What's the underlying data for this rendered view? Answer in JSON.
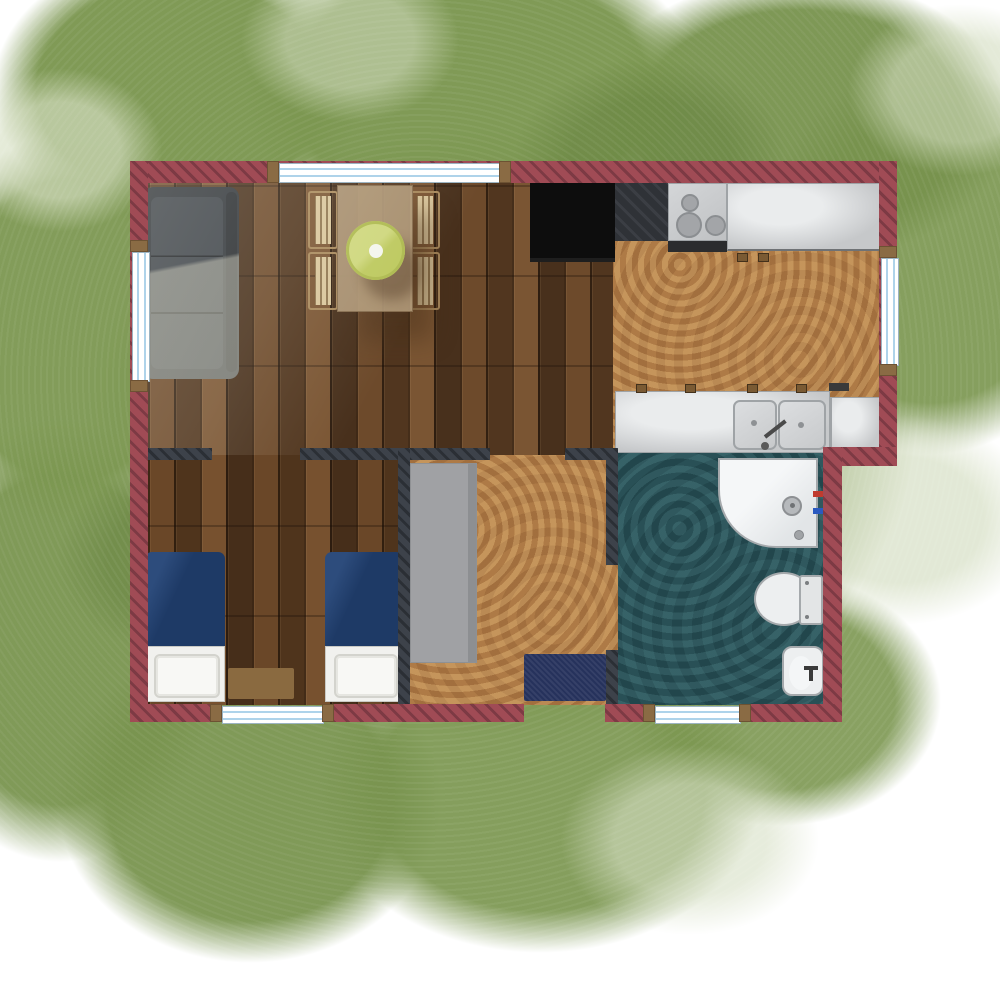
{
  "scene": {
    "type": "floor-plan",
    "description": "Top-down architectural floor plan of a small cabin set on a green watercolor foliage backdrop",
    "colors": {
      "exterior_wall": "#a04b55",
      "exterior_wall_stripe": "#7d3a44",
      "interior_wall": "#3d424a",
      "interior_wall_stripe": "#2b2f35",
      "window_glass": "#aed3ea",
      "window_frame": "#9cb4c2",
      "wall_cap": "#8a6b44",
      "wood_base": "#5f3f26",
      "wood_mid": "#6d4a2b",
      "wood_dark": "#51361f",
      "wood_light": "#7a5533",
      "cork_base": "#b17d46",
      "teal_base": "#2c5157",
      "counter_gray": "#c6c8ca",
      "counter_border": "#9fa3a6",
      "appliance_black": "#0d0d0d",
      "dark_worktop": "#2f3237",
      "sofa_dark": "#2f343a",
      "sofa_cushion": "#3b4148",
      "table_tan": "#b09877",
      "chair_tan": "#d9c69c",
      "chair_border": "#a8895c",
      "parasol_green": "#bdc95f",
      "bed_blue": "#1e3a66",
      "linen_white": "#f1f1ee",
      "rug_brown": "#8a6a40",
      "doormat_navy": "#26325c",
      "wardrobe_gray": "#9c9da0",
      "fixture_white": "#edeff0",
      "fixture_border": "#a5a9ac",
      "hot_red": "#c03b2e",
      "cold_blue": "#2a5ac0",
      "grass_green": "#7c9751",
      "grass_light": "#cdd8b8",
      "grass_dark": "#64803e"
    },
    "rooms": [
      {
        "id": "living-dining",
        "floor": "wood planks",
        "items": [
          "sofa",
          "dining table",
          "four chairs",
          "green parasol centerpiece"
        ]
      },
      {
        "id": "kitchen",
        "floor": "cork",
        "items": [
          "black appliance",
          "dark worktop",
          "stove with three burners",
          "long counter",
          "sink counter with double sink and faucet",
          "corner counter",
          "cabinet handles"
        ]
      },
      {
        "id": "bedroom",
        "floor": "wood planks",
        "items": [
          "single bed left",
          "single bed right",
          "bedside rug"
        ]
      },
      {
        "id": "hallway",
        "floor": "cork",
        "items": [
          "wardrobe",
          "navy doormat"
        ]
      },
      {
        "id": "bathroom",
        "floor": "teal vinyl",
        "items": [
          "shower tray",
          "toilet",
          "bidet",
          "hot water mark",
          "cold water mark"
        ]
      }
    ],
    "windows": [
      "top wall",
      "left wall",
      "right wall",
      "bedroom bottom wall",
      "bathroom bottom wall"
    ],
    "door_openings": [
      "living room to bedroom",
      "living room to hallway",
      "hallway to bathroom",
      "main entrance at bottom of hallway"
    ]
  }
}
